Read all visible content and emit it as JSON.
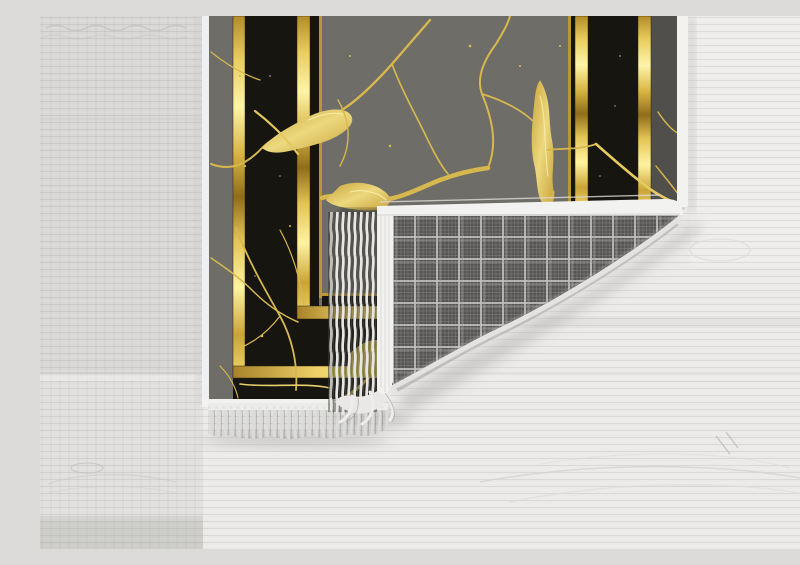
{
  "scene": {
    "description": "Product photo of a marble-patterned area rug on a whitewashed wood floor; bottom-right corner folded over showing gray plaid woven backing and white fringe",
    "objects": {
      "floor": "light whitewashed wood planks, horizontal grain",
      "rug_front": "dark gray marble field, gold crack veins, black border band framed by metallic gold lines, white edge binding",
      "rug_back": "gray plaid/tartan woven backing on folded corner",
      "fringe": "white twisted-strand fringe on bottom edge and folded edge"
    }
  },
  "colors": {
    "floor-dark": "#d9d8d6",
    "floor-light": "#ebeae8",
    "field-gray": "#6f6d68",
    "margin-dark": "#514f4b",
    "marble-black": "#17150f",
    "gold-core": "#fdf3a6",
    "gold-deep": "#8f6d1a",
    "vein-gold": "#d6b84e",
    "plaid-base": "#565554",
    "plaid-line": "#c2c2c0",
    "fringe-white": "#e7e7e5",
    "binding-white": "#f2f2f0",
    "edge-white": "#eef0f3",
    "shadow-gray": "#b5b4b2"
  }
}
